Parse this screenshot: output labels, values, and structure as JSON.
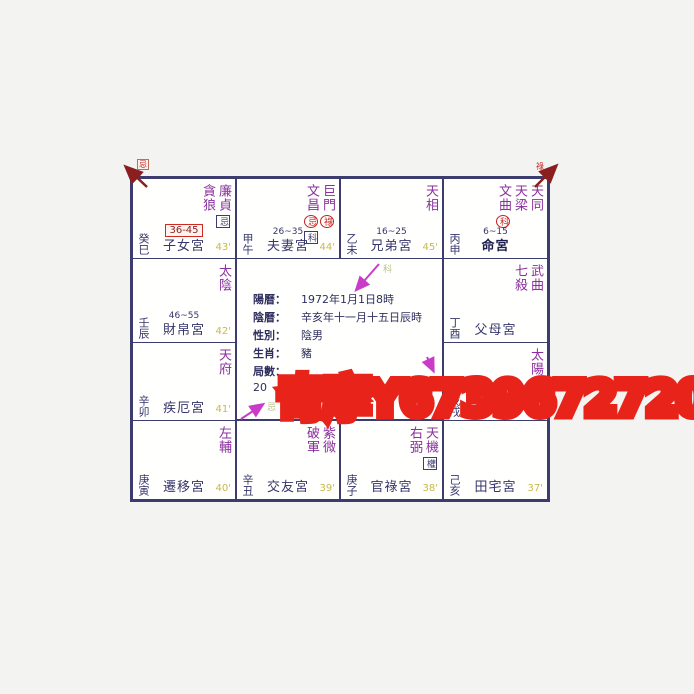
{
  "watermark": {
    "text": "奇摩Y6739672720",
    "fill_color": "#ff9222",
    "stroke_color": "#e8231a"
  },
  "info": {
    "rows": [
      {
        "label": "陽曆：",
        "value": "1972年1月1日8時"
      },
      {
        "label": "陰曆：",
        "value": "辛亥年十一月十五日辰時"
      },
      {
        "label": "性別：",
        "value": "陰男"
      },
      {
        "label": "生肖：",
        "value": "豬"
      },
      {
        "label": "局數：",
        "value": ""
      }
    ],
    "partial_line": "20"
  },
  "arrow_marks": {
    "top_left": "忌",
    "top_right": "祿",
    "siblings_edge": "科",
    "health_edge": "忌"
  },
  "colors": {
    "star_purple": "#8b2f9e",
    "text_navy": "#35356b",
    "age_yellow": "#c9b94a",
    "mark_red": "#c42222",
    "grid_line": "#3c3c6e"
  },
  "cells": [
    {
      "palace": "子女宮",
      "ganzhi": "癸巳",
      "decade": "36-45",
      "num": "43'",
      "stars": [
        {
          "name": "廉貞",
          "mark": "忌"
        },
        {
          "name": "貪狼"
        }
      ]
    },
    {
      "palace": "夫妻宮",
      "ganzhi": "甲午",
      "decade": "26~35",
      "num": "44'",
      "stars": [
        {
          "name": "巨門",
          "mark": "祿"
        },
        {
          "name": "文昌",
          "mark": "忌",
          "mark2": "科"
        }
      ]
    },
    {
      "palace": "兄弟宮",
      "ganzhi": "乙未",
      "decade": "16~25",
      "num": "45'",
      "stars": [
        {
          "name": "天相"
        }
      ]
    },
    {
      "palace": "命宮",
      "ganzhi": "丙申",
      "decade": "6~15",
      "num": "",
      "stars": [
        {
          "name": "天同"
        },
        {
          "name": "天梁"
        },
        {
          "name": "文曲",
          "mark": "科"
        }
      ]
    },
    {
      "palace": "父母宮",
      "ganzhi": "丁酉",
      "decade": "",
      "num": "",
      "stars": [
        {
          "name": "武曲"
        },
        {
          "name": "七殺"
        }
      ]
    },
    {
      "palace": "福德宮",
      "ganzhi": "戊戌",
      "decade": "",
      "num": "36'",
      "stars": [
        {
          "name": "太陽"
        }
      ]
    },
    {
      "palace": "田宅宮",
      "ganzhi": "己亥",
      "decade": "",
      "num": "37'",
      "stars": []
    },
    {
      "palace": "官祿宮",
      "ganzhi": "庚子",
      "decade": "",
      "num": "38'",
      "stars": [
        {
          "name": "天機",
          "mark": "權"
        },
        {
          "name": "右弼"
        }
      ]
    },
    {
      "palace": "交友宮",
      "ganzhi": "辛丑",
      "decade": "",
      "num": "39'",
      "stars": [
        {
          "name": "紫微"
        },
        {
          "name": "破軍"
        }
      ]
    },
    {
      "palace": "遷移宮",
      "ganzhi": "庚寅",
      "decade": "",
      "num": "40'",
      "stars": [
        {
          "name": "左輔"
        }
      ]
    },
    {
      "palace": "疾厄宮",
      "ganzhi": "辛卯",
      "decade": "",
      "num": "41'",
      "stars": [
        {
          "name": "天府"
        }
      ]
    },
    {
      "palace": "財帛宮",
      "ganzhi": "壬辰",
      "decade": "46~55",
      "num": "42'",
      "stars": [
        {
          "name": "太陰"
        }
      ]
    }
  ]
}
